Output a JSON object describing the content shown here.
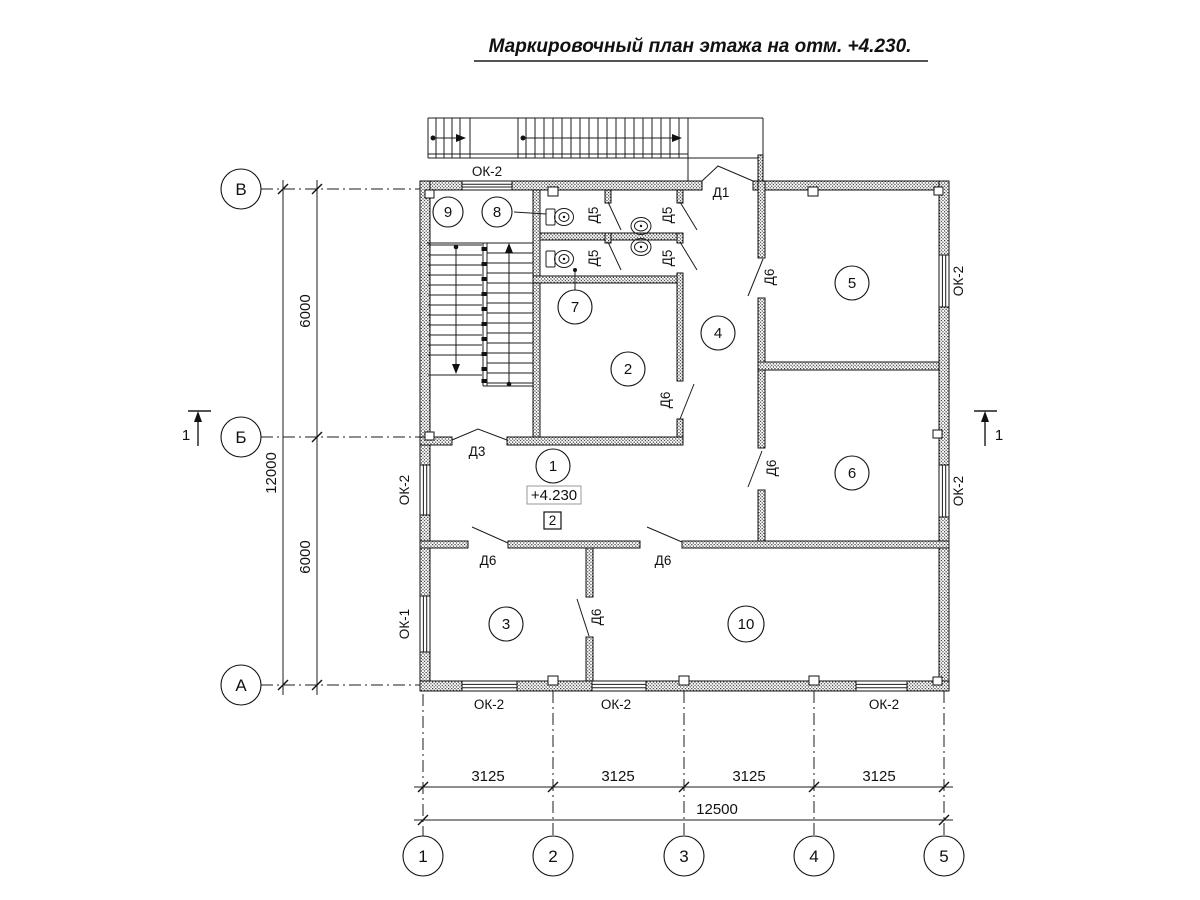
{
  "title": "Маркировочный план этажа на отм. +4.230.",
  "axis_rows": [
    "В",
    "Б",
    "А"
  ],
  "axis_cols": [
    "1",
    "2",
    "3",
    "4",
    "5"
  ],
  "rooms": [
    "1",
    "2",
    "3",
    "4",
    "5",
    "6",
    "7",
    "8",
    "9",
    "10"
  ],
  "elevation_mark": "+4.230",
  "finish_mark": "2",
  "section_mark": "1",
  "door_marks": {
    "d1": "Д1",
    "d3": "Д3",
    "d5": "Д5",
    "d6": "Д6"
  },
  "window_marks": {
    "ok1": "ОК-1",
    "ok2": "ОК-2"
  },
  "dims": {
    "bay": "3125",
    "total_width": "12500",
    "half_depth": "6000",
    "total_depth": "12000"
  },
  "drawing_colors": {
    "line": "#111111",
    "background": "#ffffff"
  }
}
